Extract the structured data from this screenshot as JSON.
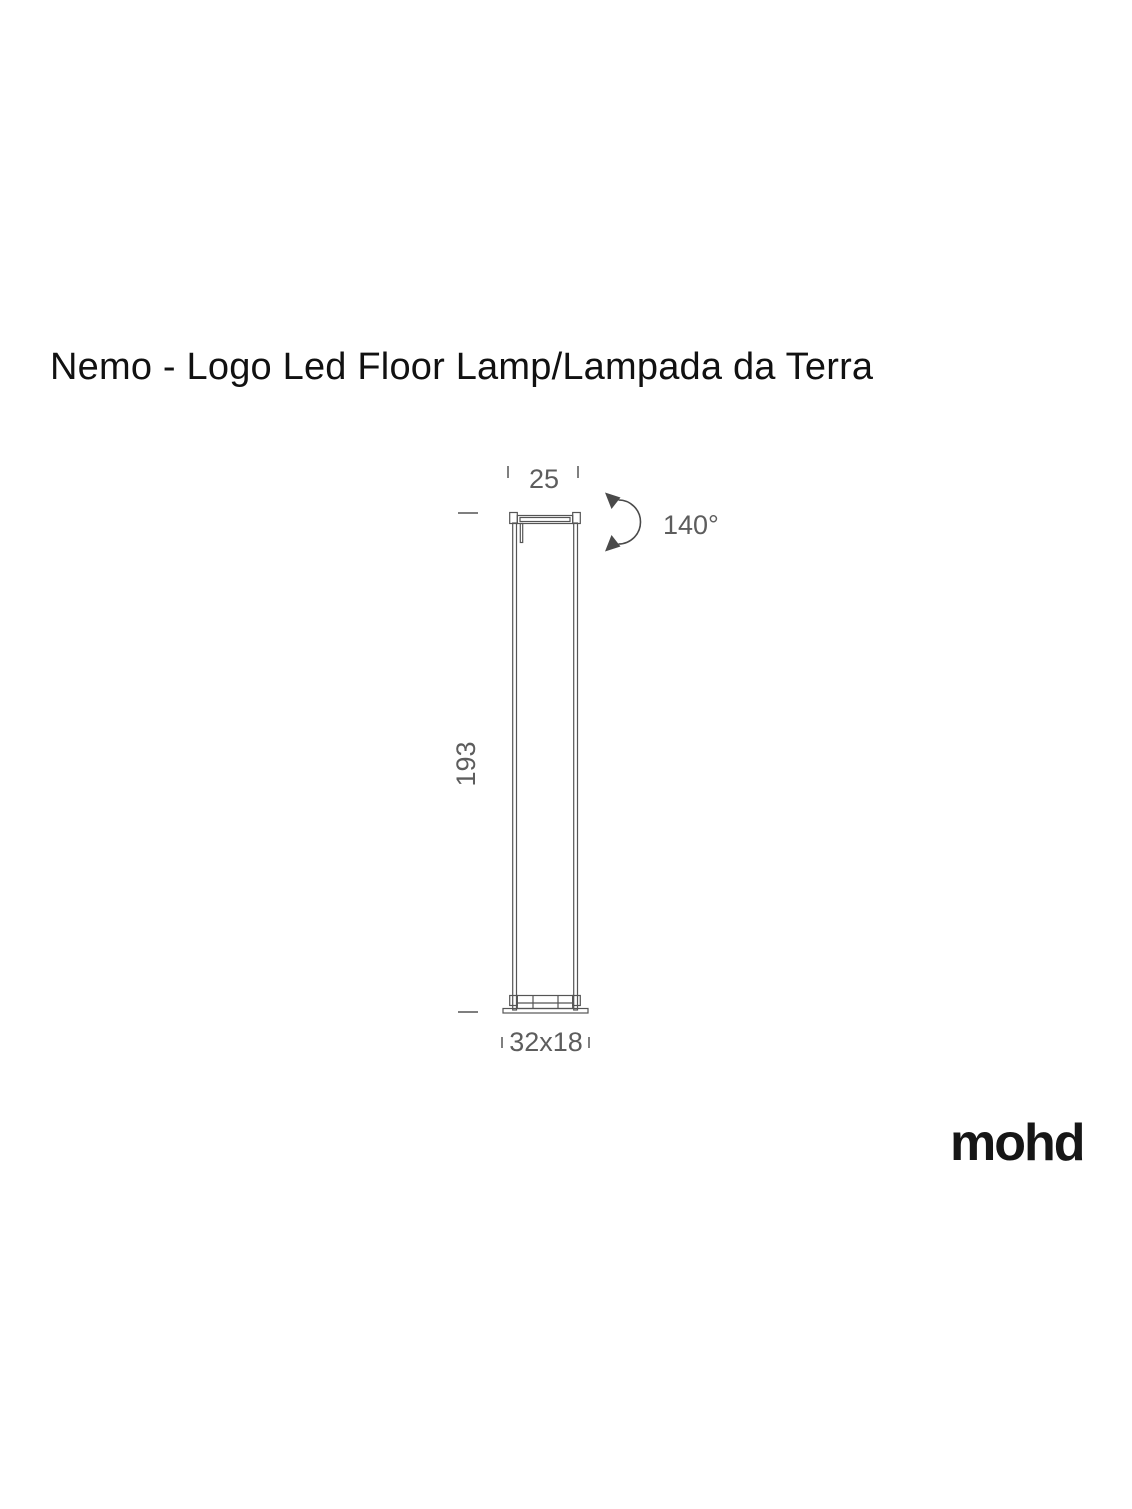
{
  "page": {
    "title": "Nemo - Logo Led Floor Lamp/Lampada da Terra",
    "brand": "mohd"
  },
  "diagram": {
    "labels": {
      "head_width": "25",
      "height": "193",
      "base": "32x18",
      "rotation": "140°"
    }
  },
  "colors": {
    "background": "#ffffff",
    "title_text": "#111111",
    "brand_text": "#161616",
    "drawing_line": "#555555",
    "dimension_text": "#5d5d5d",
    "arrow": "#4a4a4a"
  }
}
